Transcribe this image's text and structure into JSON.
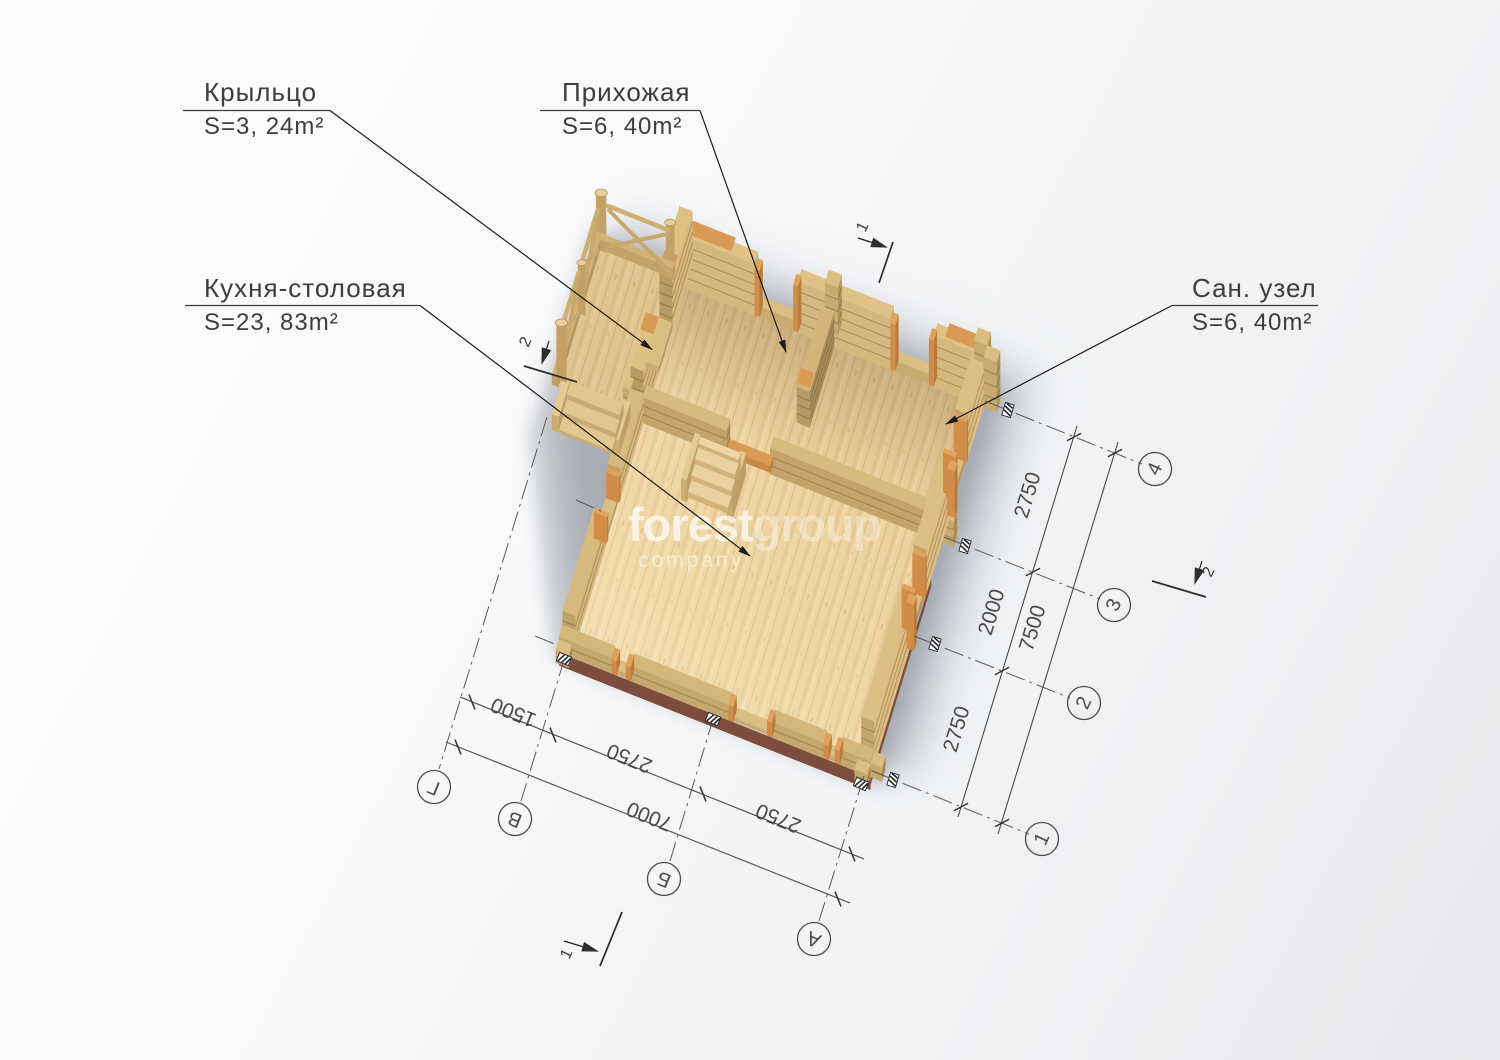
{
  "watermark": {
    "primary": "forest",
    "secondary": "group",
    "tagline": "company"
  },
  "room_labels": {
    "porch": {
      "name": "Крыльцо",
      "area": "S=3, 24m²"
    },
    "hallway": {
      "name": "Прихожая",
      "area": "S=6, 40m²"
    },
    "kitchen": {
      "name": "Кухня-столовая",
      "area": "S=23, 83m²"
    },
    "bathroom": {
      "name": "Сан. узел",
      "area": "S=6, 40m²"
    }
  },
  "dimensions": {
    "bottom": {
      "segments": [
        "1500",
        "2750",
        "2750"
      ],
      "total": "7000"
    },
    "right": {
      "segments": [
        "2750",
        "2000",
        "2750"
      ],
      "total": "7500"
    }
  },
  "axes": {
    "letters": [
      "Г",
      "В",
      "Б",
      "А"
    ],
    "numbers": [
      "4",
      "3",
      "2",
      "1"
    ]
  },
  "section_marks": {
    "one": "1",
    "two": "2"
  },
  "colors": {
    "wood_floor": "#ecd19c",
    "wood_wall_top": "#e0c288",
    "wood_wall_side": "#c9ab72",
    "trim_orange": "#d28c4a",
    "foundation_brick": "#7c4c3e",
    "annotation_line": "#4a4a4a"
  }
}
